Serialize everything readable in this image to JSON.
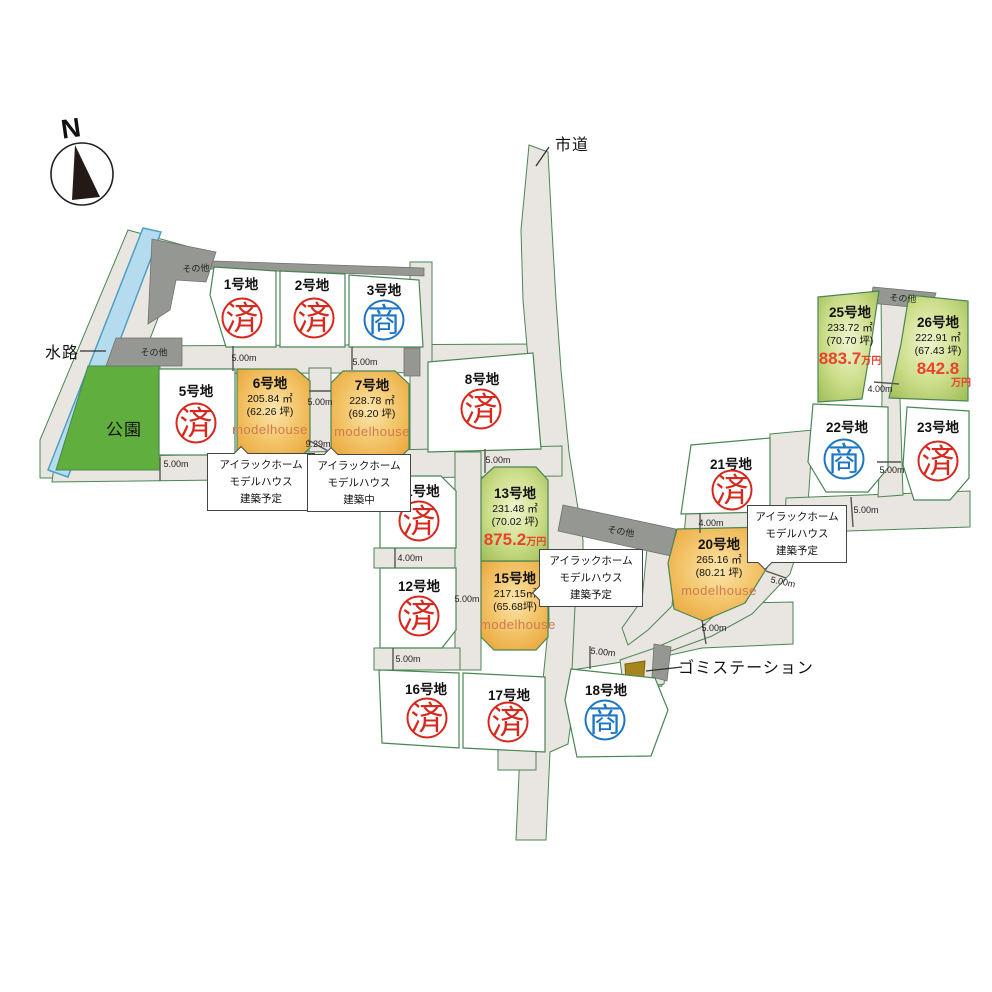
{
  "colors": {
    "road": "#e9e6e2",
    "boundary_green": "#4a8653",
    "sold_red": "#d7281d",
    "negotiation_blue": "#1d76c4",
    "price_red": "#e8432c",
    "modelhouse_text": "#cf7a50",
    "orange_lot": "#eaa93e",
    "green_lot": "#a2c05a",
    "park_green": "#5fae3e",
    "water_blue": "#b5dcee",
    "gray_area": "#949792",
    "garbage_olive": "#a5861c"
  },
  "compass": {
    "label": "N"
  },
  "labels": {
    "waterway": "水路",
    "city_road": "市道",
    "park": "公園",
    "garbage_station": "ゴミステーション"
  },
  "other_area_labels": {
    "o1": "その他",
    "o2": "その他",
    "o3": "その他",
    "o4": "その他"
  },
  "lots": {
    "l1": {
      "name": "1号地",
      "stamp": "済",
      "status": "sold"
    },
    "l2": {
      "name": "2号地",
      "stamp": "済",
      "status": "sold"
    },
    "l3": {
      "name": "3号地",
      "stamp": "商",
      "status": "negotiation"
    },
    "l5": {
      "name": "5号地",
      "stamp": "済",
      "status": "sold"
    },
    "l6": {
      "name": "6号地",
      "area": "205.84 ㎡",
      "tsubo": "(62.26 坪)",
      "modelhouse": "modelhouse"
    },
    "l7": {
      "name": "7号地",
      "area": "228.78 ㎡",
      "tsubo": "(69.20 坪)",
      "modelhouse": "modelhouse"
    },
    "l8": {
      "name": "8号地",
      "stamp": "済",
      "status": "sold"
    },
    "l11": {
      "name": "11号地",
      "stamp": "済",
      "status": "sold"
    },
    "l12": {
      "name": "12号地",
      "stamp": "済",
      "status": "sold"
    },
    "l13": {
      "name": "13号地",
      "area": "231.48 ㎡",
      "tsubo": "(70.02 坪)",
      "price": "875.2",
      "price_unit": "万円"
    },
    "l15": {
      "name": "15号地",
      "area": "217.15㎡",
      "tsubo": "(65.68坪)",
      "modelhouse": "modelhouse"
    },
    "l16": {
      "name": "16号地",
      "stamp": "済",
      "status": "sold"
    },
    "l17": {
      "name": "17号地",
      "stamp": "済",
      "status": "sold"
    },
    "l18": {
      "name": "18号地",
      "stamp": "商",
      "status": "negotiation"
    },
    "l20": {
      "name": "20号地",
      "area": "265.16 ㎡",
      "tsubo": "(80.21 坪)",
      "modelhouse": "modelhouse"
    },
    "l21": {
      "name": "21号地",
      "stamp": "済",
      "status": "sold"
    },
    "l22": {
      "name": "22号地",
      "stamp": "商",
      "status": "negotiation"
    },
    "l23": {
      "name": "23号地",
      "stamp": "済",
      "status": "sold"
    },
    "l25": {
      "name": "25号地",
      "area": "233.72 ㎡",
      "tsubo": "(70.70 坪)",
      "price": "883.7",
      "price_unit": "万円"
    },
    "l26": {
      "name": "26号地",
      "area": "222.91 ㎡",
      "tsubo": "(67.43 坪)",
      "price": "842.8",
      "price_unit": "万円"
    }
  },
  "callouts": {
    "c1": {
      "line1": "アイラックホーム",
      "line2": "モデルハウス",
      "line3": "建築予定"
    },
    "c2": {
      "line1": "アイラックホーム",
      "line2": "モデルハウス",
      "line3": "建築中"
    },
    "c3": {
      "line1": "アイラックホーム",
      "line2": "モデルハウス",
      "line3": "建築予定"
    },
    "c4": {
      "line1": "アイラックホーム",
      "line2": "モデルハウス",
      "line3": "建築予定"
    }
  },
  "measurements": {
    "m1": "5.00m",
    "m2": "5.00m",
    "m3": "5.00m",
    "m4": "9.29m",
    "m5": "5.00m",
    "m6": "5.00m",
    "m7": "4.00m",
    "m8": "5.00m",
    "m9": "5.00m",
    "m10": "5.00m",
    "m11": "4.00m",
    "m12": "5.00m",
    "m13": "5.00m",
    "m14": "4.00m",
    "m15": "5.00m",
    "m16": "5.00m"
  }
}
